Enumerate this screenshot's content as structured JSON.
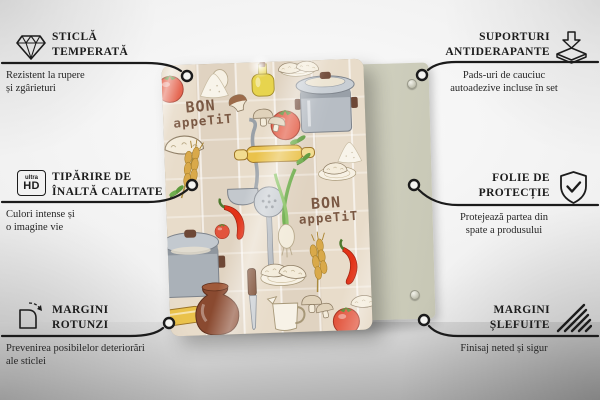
{
  "features_left": [
    {
      "icon": "diamond-icon",
      "title_lines": [
        "STICLĂ",
        "TEMPERATĂ"
      ],
      "desc_lines": [
        "Rezistent la rupere",
        "și zgârieturi"
      ]
    },
    {
      "icon": "ultra-hd-icon",
      "icon_text": {
        "top": "ultra",
        "bottom": "HD"
      },
      "title_lines": [
        "TIPĂRIRE DE",
        "ÎNALTĂ CALITATE"
      ],
      "desc_lines": [
        "Culori intense și",
        "o imagine vie"
      ]
    },
    {
      "icon": "rounded-corner-icon",
      "title_lines": [
        "MARGINI",
        "ROTUNZI"
      ],
      "desc_lines": [
        "Prevenirea posibilelor deteriorări",
        "ale sticlei"
      ]
    }
  ],
  "features_right": [
    {
      "icon": "anti-slip-pads-icon",
      "title_lines": [
        "SUPORTURI",
        "ANTIDERAPANTE"
      ],
      "desc_lines": [
        "Pads-uri de cauciuc",
        "autoadezive incluse în set"
      ]
    },
    {
      "icon": "shield-check-icon",
      "title_lines": [
        "FOLIE DE",
        "PROTECȚIE"
      ],
      "desc_lines": [
        "Protejează partea din",
        "spate a produsului"
      ]
    },
    {
      "icon": "polished-edge-icon",
      "title_lines": [
        "MARGINI",
        "ȘLEFUITE"
      ],
      "desc_lines": [
        "Finisaj neted și sigur"
      ]
    }
  ],
  "product": {
    "print_text": {
      "line1": "BON",
      "line2": "appeTiT"
    },
    "illustration_items": [
      "stock-pot",
      "tomato",
      "dumplings",
      "mushrooms",
      "oil-bottle",
      "rolling-pin",
      "wheat",
      "chili-pepper",
      "ladle",
      "skimmer",
      "green-onion",
      "herbs",
      "flour-pile",
      "clay-jug",
      "knife",
      "milk-jug"
    ],
    "colors": {
      "board_background": "#e8dcca",
      "print_text_brown": "#7a5843",
      "tomato_red": "#e2543c",
      "pot_gray": "#b7bdc4",
      "rolling_pin_yellow": "#eac24b",
      "back_panel_sage": "#d6d5c3"
    }
  }
}
